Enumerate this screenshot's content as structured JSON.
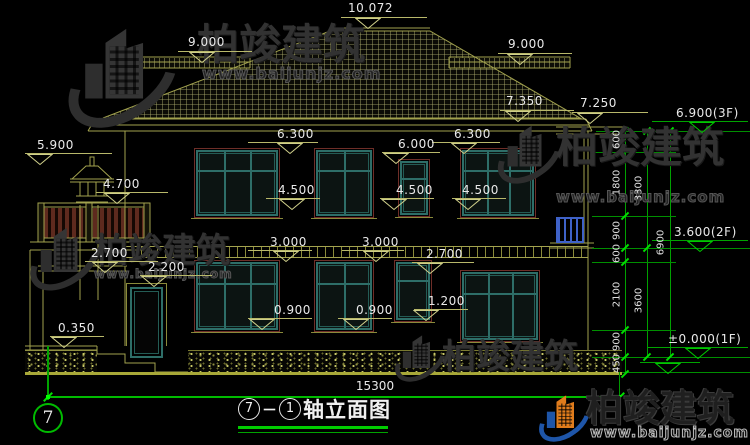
{
  "drawing_title": {
    "axis_from": "7",
    "dash": "－",
    "axis_to": "1",
    "name": "轴立面图"
  },
  "axis_bubble_label": "7",
  "bottom_dimension": "15300",
  "watermark_brand": "柏竣建筑",
  "watermark_url": "www.baijunjz.com",
  "colors": {
    "linework_yellow": "#a2a24e",
    "dimension_green": "#00bb00",
    "window_teal": "#2e6e68",
    "surround_maroon": "#6e2e28",
    "railing_brown": "#5e2a1e",
    "balcony_blue": "#3f62c8",
    "logo_blue": "#1e55a8",
    "logo_orange": "#e07c1c",
    "text_white": "#e9e9e9"
  },
  "level_markers": [
    {
      "label": "10.072",
      "tx": 348,
      "ty": 2,
      "lx1": 341,
      "lx2": 427,
      "ly": 17,
      "tri": 368,
      "g": false
    },
    {
      "label": "9.000",
      "tx": 188,
      "ty": 36,
      "lx1": 178,
      "lx2": 252,
      "ly": 51,
      "tri": 202,
      "g": false
    },
    {
      "label": "9.000",
      "tx": 508,
      "ty": 38,
      "lx1": 498,
      "lx2": 572,
      "ly": 53,
      "tri": 520,
      "g": false
    },
    {
      "label": "7.350",
      "tx": 506,
      "ty": 95,
      "lx1": 500,
      "lx2": 574,
      "ly": 110,
      "tri": 518,
      "g": false
    },
    {
      "label": "7.250",
      "tx": 580,
      "ty": 97,
      "lx1": 572,
      "lx2": 648,
      "ly": 112,
      "tri": 590,
      "g": false
    },
    {
      "label": "6.900(3F)",
      "tx": 676,
      "ty": 107,
      "lx1": 652,
      "lx2": 748,
      "ly": 121,
      "tri": 702,
      "g": true
    },
    {
      "label": "3.600(2F)",
      "tx": 674,
      "ty": 226,
      "lx1": 652,
      "lx2": 748,
      "ly": 240,
      "tri": 700,
      "g": true
    },
    {
      "label": "±0.000(1F)",
      "tx": 668,
      "ty": 333,
      "lx1": 648,
      "lx2": 748,
      "ly": 347,
      "tri": 698,
      "g": true
    },
    {
      "label": "",
      "tx": 660,
      "ty": 352,
      "lx1": 640,
      "lx2": 700,
      "ly": 362,
      "tri": 668,
      "g": true
    },
    {
      "label": "5.900",
      "tx": 37,
      "ty": 139,
      "lx1": 25,
      "lx2": 112,
      "ly": 153,
      "tri": 40,
      "g": false
    },
    {
      "label": "4.700",
      "tx": 103,
      "ty": 178,
      "lx1": 96,
      "lx2": 168,
      "ly": 192,
      "tri": 117,
      "g": false
    },
    {
      "label": "2.700",
      "tx": 91,
      "ty": 247,
      "lx1": 85,
      "lx2": 158,
      "ly": 261,
      "tri": 105,
      "g": false
    },
    {
      "label": "2.200",
      "tx": 148,
      "ty": 261,
      "lx1": 140,
      "lx2": 212,
      "ly": 275,
      "tri": 154,
      "g": false
    },
    {
      "label": "0.350",
      "tx": 58,
      "ty": 322,
      "lx1": 50,
      "lx2": 104,
      "ly": 336,
      "tri": 64,
      "g": false
    },
    {
      "label": "6.300",
      "tx": 277,
      "ty": 128,
      "lx1": 248,
      "lx2": 318,
      "ly": 142,
      "tri": 290,
      "g": false
    },
    {
      "label": "6.300",
      "tx": 454,
      "ty": 128,
      "lx1": 432,
      "lx2": 500,
      "ly": 142,
      "tri": 464,
      "g": false
    },
    {
      "label": "6.000",
      "tx": 398,
      "ty": 138,
      "lx1": 382,
      "lx2": 440,
      "ly": 152,
      "tri": 396,
      "g": false
    },
    {
      "label": "4.500",
      "tx": 278,
      "ty": 184,
      "lx1": 266,
      "lx2": 320,
      "ly": 198,
      "tri": 292,
      "g": false
    },
    {
      "label": "4.500",
      "tx": 396,
      "ty": 184,
      "lx1": 380,
      "lx2": 434,
      "ly": 198,
      "tri": 394,
      "g": false
    },
    {
      "label": "4.500",
      "tx": 462,
      "ty": 184,
      "lx1": 452,
      "lx2": 506,
      "ly": 198,
      "tri": 468,
      "g": false
    },
    {
      "label": "3.000",
      "tx": 270,
      "ty": 236,
      "lx1": 248,
      "lx2": 312,
      "ly": 250,
      "tri": 286,
      "g": false
    },
    {
      "label": "3.000",
      "tx": 362,
      "ty": 236,
      "lx1": 342,
      "lx2": 404,
      "ly": 250,
      "tri": 376,
      "g": false
    },
    {
      "label": "2.700",
      "tx": 426,
      "ty": 248,
      "lx1": 412,
      "lx2": 474,
      "ly": 262,
      "tri": 430,
      "g": false
    },
    {
      "label": "0.900",
      "tx": 274,
      "ty": 304,
      "lx1": 248,
      "lx2": 312,
      "ly": 318,
      "tri": 262,
      "g": false
    },
    {
      "label": "0.900",
      "tx": 356,
      "ty": 304,
      "lx1": 338,
      "lx2": 392,
      "ly": 318,
      "tri": 356,
      "g": false
    },
    {
      "label": "1.200",
      "tx": 428,
      "ty": 295,
      "lx1": 414,
      "lx2": 468,
      "ly": 309,
      "tri": 426,
      "g": false
    }
  ],
  "dimension_chain": {
    "columns": [
      {
        "x": 625,
        "y1": 131,
        "y2": 374,
        "ticks": [
          131,
          152,
          216,
          248,
          262,
          330,
          357,
          374
        ]
      },
      {
        "x": 647,
        "y1": 131,
        "y2": 357,
        "ticks": [
          131,
          248,
          357
        ]
      },
      {
        "x": 670,
        "y1": 131,
        "y2": 357,
        "ticks": [
          131,
          357
        ]
      }
    ],
    "segment_labels": [
      {
        "t": "600",
        "x": 617,
        "y": 141
      },
      {
        "t": "1800",
        "x": 617,
        "y": 184
      },
      {
        "t": "900",
        "x": 617,
        "y": 232
      },
      {
        "t": "600",
        "x": 617,
        "y": 255
      },
      {
        "t": "2100",
        "x": 617,
        "y": 296
      },
      {
        "t": "900",
        "x": 617,
        "y": 343
      },
      {
        "t": "450",
        "x": 617,
        "y": 365
      },
      {
        "t": "3300",
        "x": 639,
        "y": 190
      },
      {
        "t": "3600",
        "x": 639,
        "y": 302
      },
      {
        "t": "6900",
        "x": 661,
        "y": 244
      }
    ],
    "ext_lines": [
      {
        "x": 596,
        "w": 154,
        "y": 131
      },
      {
        "x": 592,
        "w": 84,
        "y": 152
      },
      {
        "x": 592,
        "w": 84,
        "y": 216
      },
      {
        "x": 592,
        "w": 158,
        "y": 248
      },
      {
        "x": 592,
        "w": 84,
        "y": 262
      },
      {
        "x": 592,
        "w": 84,
        "y": 330
      },
      {
        "x": 592,
        "w": 158,
        "y": 357
      },
      {
        "x": 622,
        "w": 128,
        "y": 372
      }
    ]
  },
  "windows": [
    {
      "x": 196,
      "y": 150,
      "w": 82,
      "h": 66,
      "cols": 3
    },
    {
      "x": 316,
      "y": 150,
      "w": 56,
      "h": 66,
      "cols": 2
    },
    {
      "x": 400,
      "y": 161,
      "w": 28,
      "h": 54,
      "cols": 1
    },
    {
      "x": 462,
      "y": 150,
      "w": 72,
      "h": 66,
      "cols": 3
    },
    {
      "x": 196,
      "y": 262,
      "w": 82,
      "h": 68,
      "cols": 3
    },
    {
      "x": 316,
      "y": 262,
      "w": 56,
      "h": 68,
      "cols": 2
    },
    {
      "x": 396,
      "y": 262,
      "w": 34,
      "h": 58,
      "cols": 1
    },
    {
      "x": 462,
      "y": 272,
      "w": 76,
      "h": 68,
      "cols": 3
    }
  ],
  "watermark_instances": [
    {
      "style": "gray",
      "icon": {
        "x": 62,
        "y": 26,
        "s": 1.45
      },
      "text": {
        "x": 197,
        "y": 24,
        "size": 42
      },
      "url": {
        "x": 202,
        "y": 66,
        "size": 16
      }
    },
    {
      "style": "gray",
      "icon": {
        "x": 494,
        "y": 124,
        "s": 0.85
      },
      "text": {
        "x": 556,
        "y": 127,
        "size": 42
      },
      "url": {
        "x": 556,
        "y": 190,
        "size": 15
      }
    },
    {
      "style": "gray",
      "icon": {
        "x": 26,
        "y": 226,
        "s": 0.92
      },
      "text": {
        "x": 94,
        "y": 234,
        "size": 34
      },
      "url": {
        "x": 94,
        "y": 268,
        "size": 12
      }
    },
    {
      "style": "gray",
      "icon": {
        "x": 392,
        "y": 334,
        "s": 0.68
      },
      "text": {
        "x": 442,
        "y": 340,
        "size": 34
      },
      "url": null
    },
    {
      "style": "dark colored",
      "icon": {
        "x": 536,
        "y": 394,
        "s": 0.68
      },
      "text": {
        "x": 586,
        "y": 390,
        "size": 37
      },
      "url": {
        "x": 590,
        "y": 426,
        "size": 14
      }
    }
  ]
}
